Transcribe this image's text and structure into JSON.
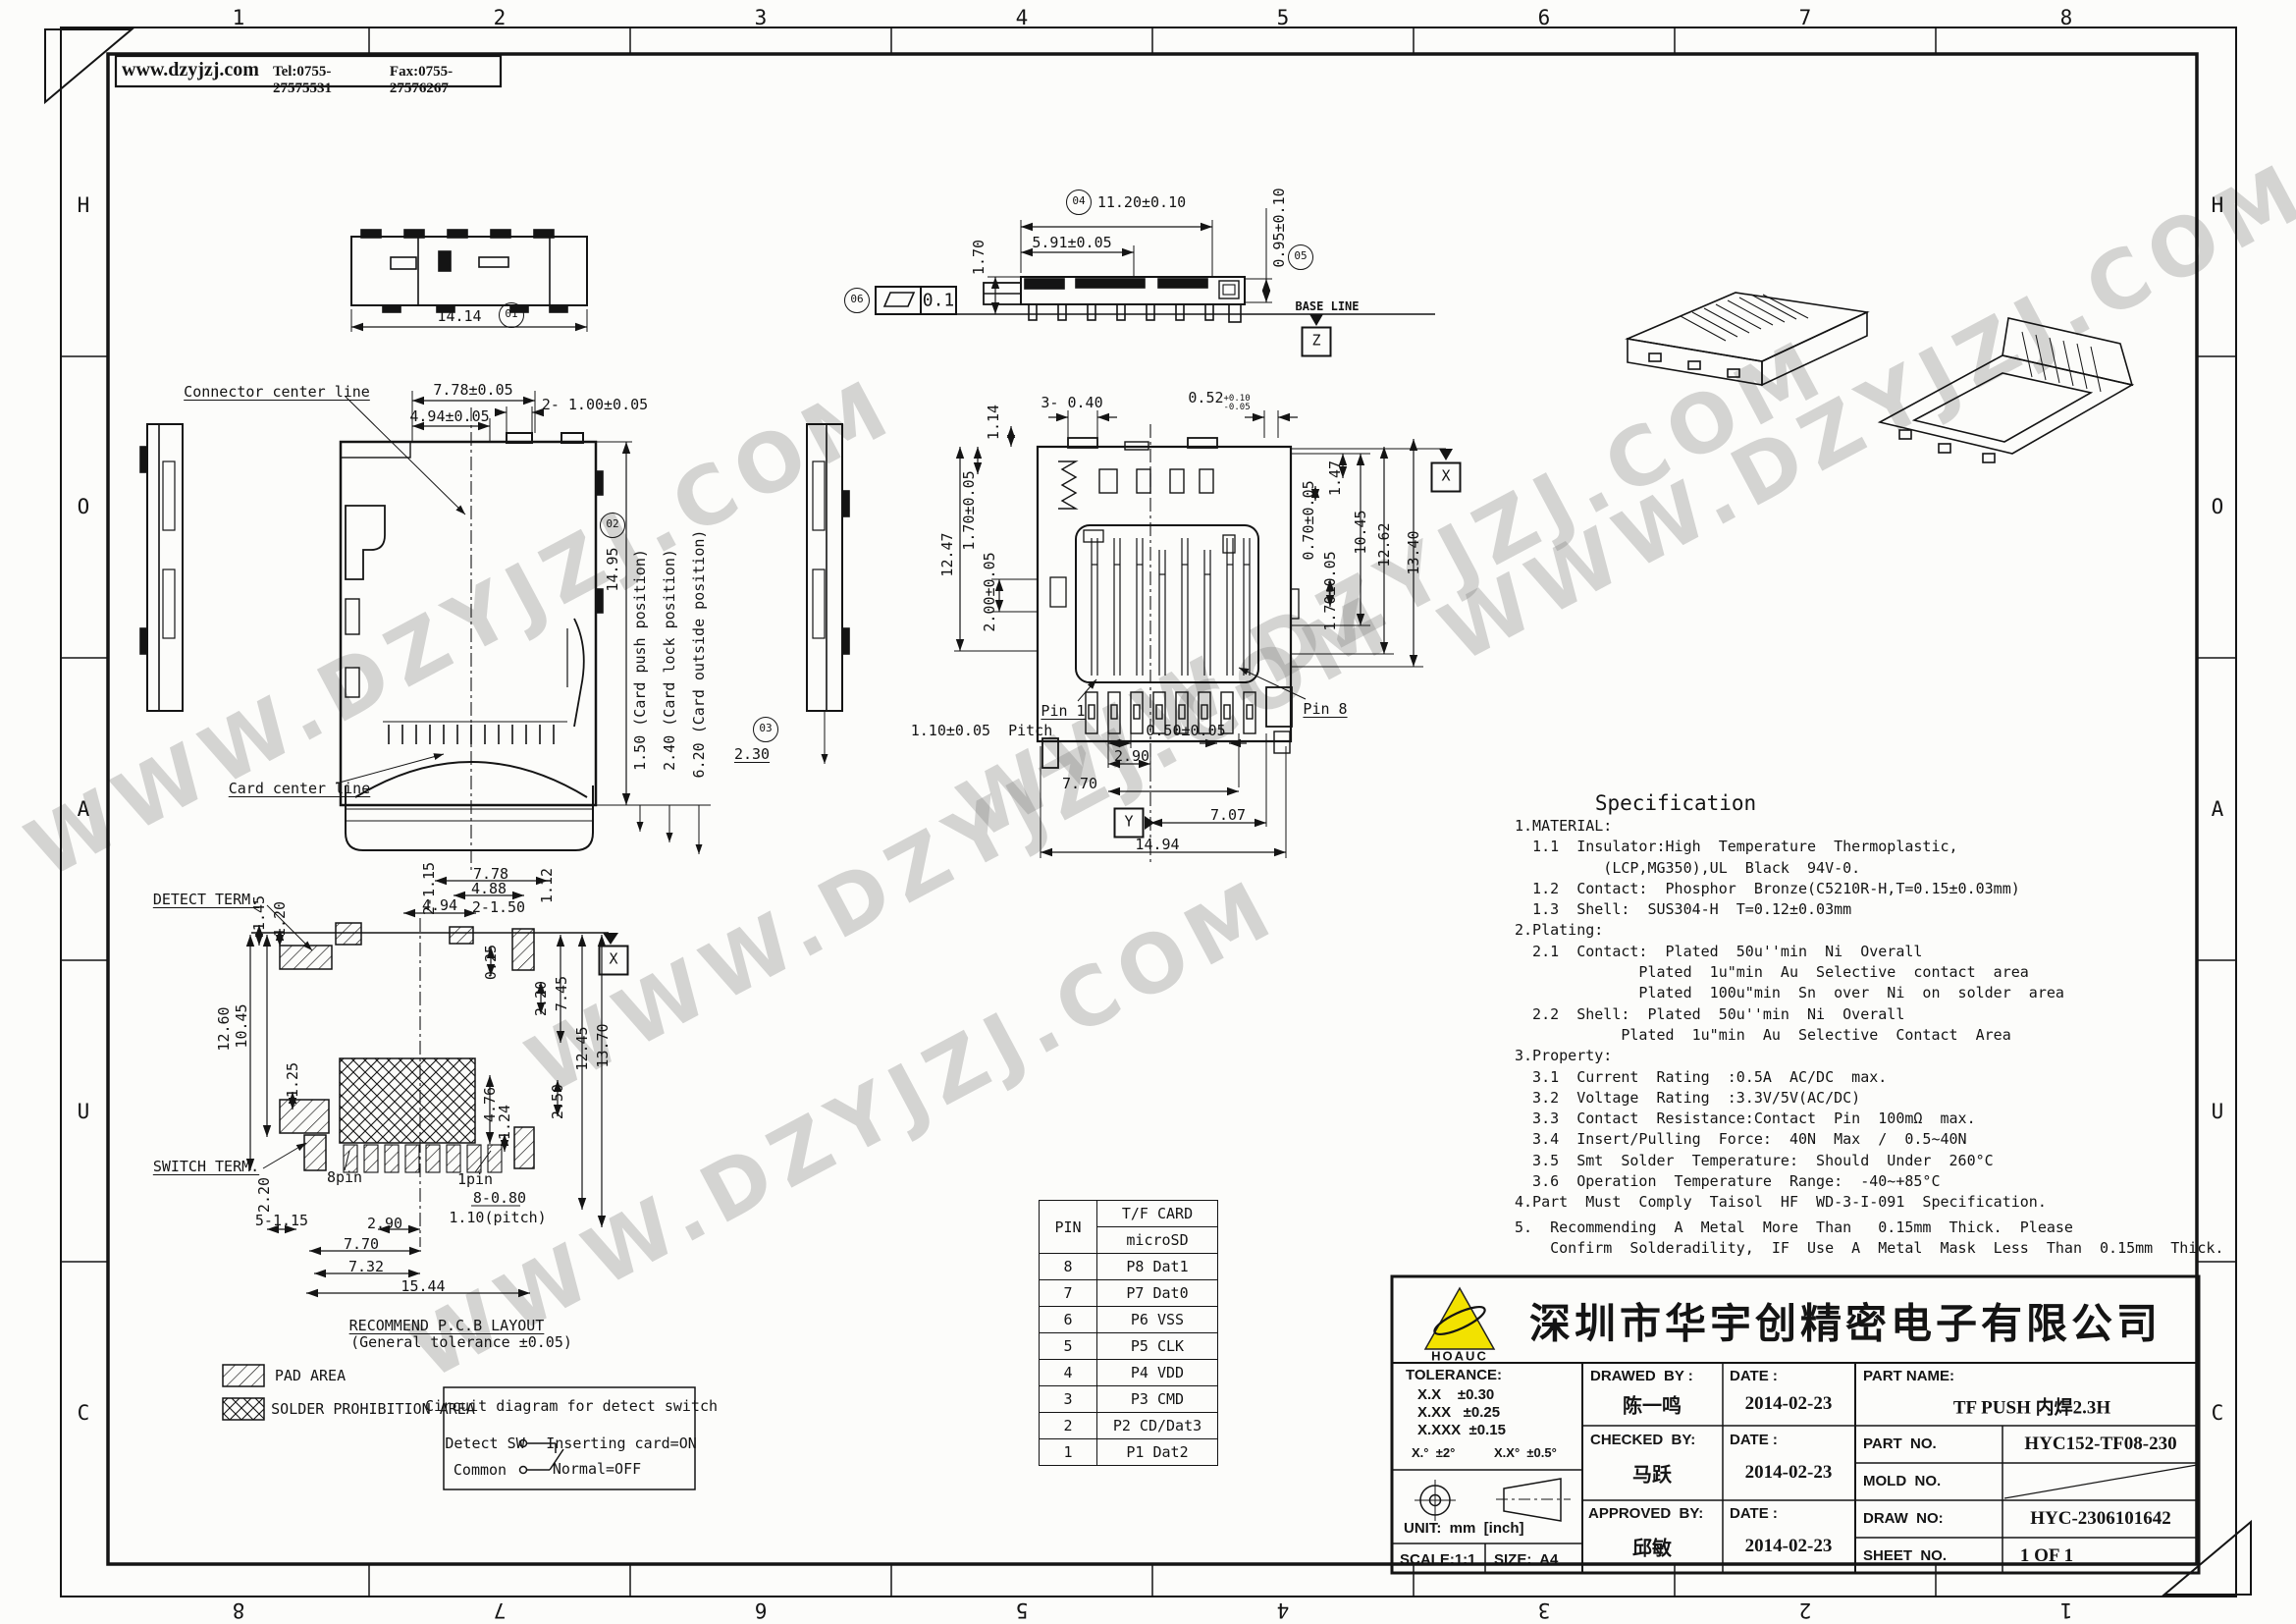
{
  "header": {
    "website": "www.dzyjzj.com",
    "tel": "Tel:0755-27575531",
    "fax": "Fax:0755-27576267"
  },
  "zones": {
    "top": [
      "1",
      "2",
      "3",
      "4",
      "5",
      "6",
      "7",
      "8"
    ],
    "bottom": [
      "8",
      "7",
      "6",
      "5",
      "4",
      "3",
      "2",
      "1"
    ],
    "left": [
      "H",
      "O",
      "A",
      "U",
      "C"
    ],
    "right": [
      "H",
      "O",
      "A",
      "U",
      "C"
    ]
  },
  "watermark": {
    "text": "WWW.DZYJZJ.COM"
  },
  "front": {
    "center_line": "Connector center line",
    "card_line": "Card center line",
    "d1414": "14.14",
    "b01": "01",
    "d778": "7.78±0.05",
    "d494": "4.94±0.05",
    "d2x100": "2- 1.00±0.05",
    "d1495": "14.95",
    "b02": "02",
    "push": "1.50 (Card push position)",
    "lock": "2.40 (Card lock position)",
    "outside": "6.20 (Card outside position)",
    "d230": "2.30",
    "b03": "03"
  },
  "section": {
    "b04": "04",
    "d1120": "11.20±0.10",
    "d591": "5.91±0.05",
    "d170": "1.70",
    "d095": "0.95±0.10",
    "b05": "05",
    "b06": "06",
    "flat": "0.1",
    "baseline": "BASE LINE",
    "dz": "Z"
  },
  "bottom": {
    "d114": "1.14",
    "d3x040": "3- 0.40",
    "d052": "0.52",
    "tol_up": "+0.10",
    "tol_dn": "-0.05",
    "d1247": "12.47",
    "d170l": "1.70±0.05",
    "d200": "2.00±0.05",
    "d147": "1.47",
    "d070": "0.70±0.05",
    "d1045": "10.45",
    "d1262": "12.62",
    "d1340": "13.40",
    "d170r": "1.70±0.05",
    "dx": "X",
    "pin1": "Pin 1",
    "pin8": "Pin 8",
    "pitch": "1.10±0.05  Pitch",
    "d050": "0.50±0.05",
    "d290": "2.90",
    "d770": "7.70",
    "d707": "7.07",
    "dy": "Y",
    "d1494": "14.94"
  },
  "pcb": {
    "title": "RECOMMEND P.C.B LAYOUT",
    "subtitle": "(General tolerance ±0.05)",
    "detect": "DETECT TERM.",
    "switch": "SWITCH TERM.",
    "dx": "X",
    "d778": "7.78",
    "d494": "4.94",
    "d2x115": "2-1.15",
    "d488": "4.88",
    "d2x150": "2-1.50",
    "d112": "1.12",
    "d145": "1.45",
    "d120": "1.20",
    "d025": "0.25",
    "d220a": "2.20",
    "d745": "7.45",
    "d1045": "10.45",
    "d1260": "12.60",
    "d125": "1.25",
    "d1245": "12.45",
    "d1370": "13.70",
    "d476": "4.76",
    "d124": "1.24",
    "d250": "2.50",
    "d220b": "2.20",
    "d5x115": "5-1.15",
    "p8": "8pin",
    "p1": "1pin",
    "d8x080": "8-0.80",
    "dpitch": "1.10(pitch)",
    "d290": "2.90",
    "d770": "7.70",
    "d732": "7.32",
    "d1544": "15.44"
  },
  "legend": {
    "pad": "PAD AREA",
    "solder": "SOLDER PROHIBITION AREA",
    "circuit_title": "Circuit diagram for detect switch",
    "detect_sw": "Detect SW",
    "inserting": "Inserting card=ON",
    "common": "Common",
    "normal": "Normal=OFF"
  },
  "pin_table": {
    "col_pin": "PIN",
    "header1": "T/F CARD",
    "header2": "microSD",
    "rows": [
      [
        "8",
        "P8 Dat1"
      ],
      [
        "7",
        "P7 Dat0"
      ],
      [
        "6",
        "P6 VSS"
      ],
      [
        "5",
        "P5 CLK"
      ],
      [
        "4",
        "P4 VDD"
      ],
      [
        "3",
        "P3 CMD"
      ],
      [
        "2",
        "P2 CD/Dat3"
      ],
      [
        "1",
        "P1 Dat2"
      ]
    ]
  },
  "spec": {
    "title": "Specification",
    "lines": [
      "1.MATERIAL:",
      "  1.1  Insulator:High  Temperature  Thermoplastic,",
      "          (LCP,MG350),UL  Black  94V-0.",
      "  1.2  Contact:  Phosphor  Bronze(C5210R-H,T=0.15±0.03mm)",
      "  1.3  Shell:  SUS304-H  T=0.12±0.03mm",
      "2.Plating:",
      "  2.1  Contact:  Plated  50u''min  Ni  Overall",
      "              Plated  1u\"min  Au  Selective  contact  area",
      "              Plated  100u\"min  Sn  over  Ni  on  solder  area",
      "  2.2  Shell:  Plated  50u''min  Ni  Overall",
      "            Plated  1u\"min  Au  Selective  Contact  Area",
      "3.Property:",
      "  3.1  Current  Rating  :0.5A  AC/DC  max.",
      "  3.2  Voltage  Rating  :3.3V/5V(AC/DC)",
      "  3.3  Contact  Resistance:Contact  Pin  100mΩ  max.",
      "  3.4  Insert/Pulling  Force:  40N  Max  /  0.5~40N",
      "  3.5  Smt  Solder  Temperature:  Should  Under  260°C",
      "  3.6  Operation  Temperature  Range:  -40~+85°C",
      "4.Part  Must  Comply  Taisol  HF  WD-3-I-091  Specification.",
      "5.  Recommending  A  Metal  More  Than   0.15mm  Thick.  Please",
      "    Confirm  Solderadility,  IF  Use  A  Metal  Mask  Less  Than  0.15mm  Thick."
    ]
  },
  "tb": {
    "logo_text": "HOAUC",
    "company": "深圳市华宇创精密电子有限公司",
    "tolerance_label": "TOLERANCE:",
    "tol1": "X.X    ±0.30",
    "tol2": "X.XX   ±0.25",
    "tol3": "X.XXX  ±0.15",
    "tol_ang1": "X.°  ±2°",
    "tol_ang2": "X.X°  ±0.5°",
    "unit": "UNIT:  mm  [inch]",
    "scale": "SCALE:1:1",
    "size": "SIZE:  A4",
    "drawed_label": "DRAWED  BY :",
    "drawed_by": "陈一鸣",
    "date_label1": "DATE :",
    "date1": "2014-02-23",
    "checked_label": "CHECKED  BY:",
    "checked_by": "马跃",
    "date_label2": "DATE :",
    "date2": "2014-02-23",
    "approved_label": "APPROVED  BY:",
    "approved_by": "邱敏",
    "date_label3": "DATE :",
    "date3": "2014-02-23",
    "part_name_label": "PART NAME:",
    "part_name": "TF PUSH 内焊2.3H",
    "part_no_label": "PART  NO.",
    "part_no": "HYC152-TF08-230",
    "mold_no_label": "MOLD  NO.",
    "draw_no_label": "DRAW  NO:",
    "draw_no": "HYC-2306101642",
    "sheet_no_label": "SHEET  NO.",
    "sheet_no": "1 OF 1"
  }
}
